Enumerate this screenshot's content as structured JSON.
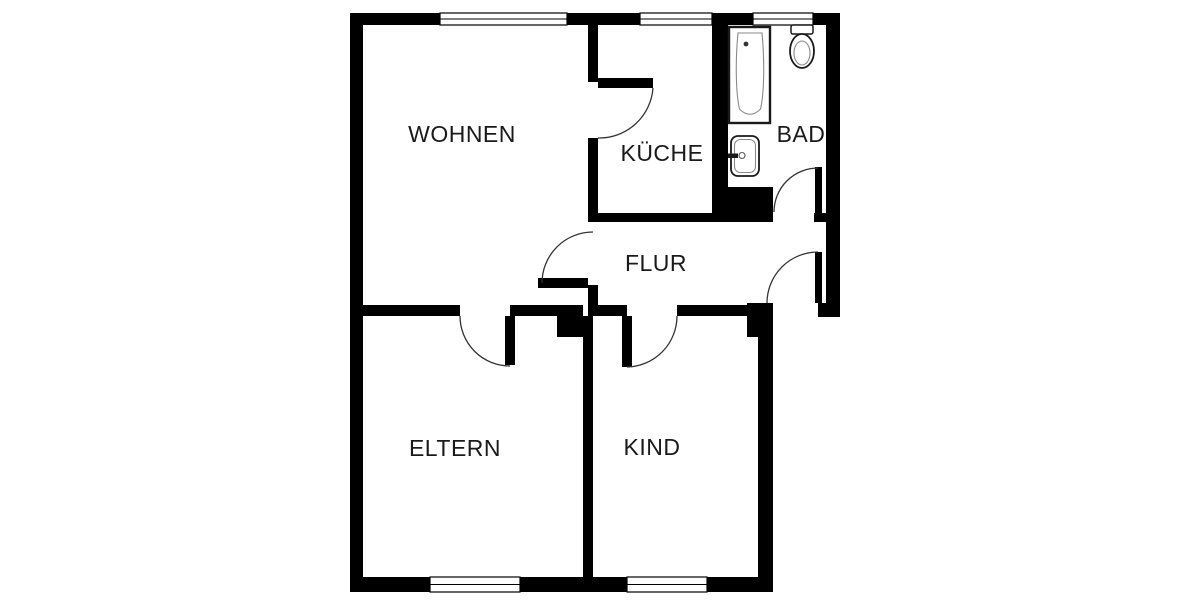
{
  "floorplan": {
    "background_color": "#ffffff",
    "wall_color": "#000000",
    "text_color": "#1a1a1a",
    "rooms": [
      {
        "id": "wohnen",
        "label": "WOHNEN"
      },
      {
        "id": "kueche",
        "label": "KÜCHE"
      },
      {
        "id": "bad",
        "label": "BAD"
      },
      {
        "id": "flur",
        "label": "FLUR"
      },
      {
        "id": "eltern",
        "label": "ELTERN"
      },
      {
        "id": "kind",
        "label": "KIND"
      }
    ],
    "fixtures": [
      {
        "id": "bathtub",
        "name": "bathtub"
      },
      {
        "id": "toilet",
        "name": "toilet"
      },
      {
        "id": "sink",
        "name": "sink"
      }
    ],
    "counts": {
      "windows": 5,
      "doors": 6
    }
  }
}
